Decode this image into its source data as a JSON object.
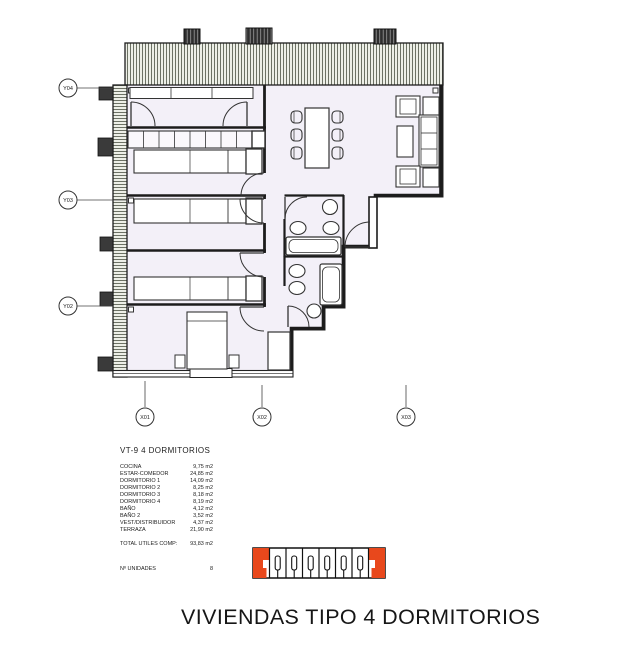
{
  "plan": {
    "markers": {
      "y04": "Y04",
      "y03": "Y03",
      "y02": "Y02",
      "x01": "X01",
      "x02": "X02",
      "x03": "X03"
    }
  },
  "summary": {
    "heading": "VT-9  4 DORMITORIOS",
    "rows": [
      {
        "label": "COCINA",
        "value": "9,75 m2"
      },
      {
        "label": "ESTAR-COMEDOR",
        "value": "24,85 m2"
      },
      {
        "label": "DORMITORIO 1",
        "value": "14,09 m2"
      },
      {
        "label": "DORMITORIO 2",
        "value": "8,25 m2"
      },
      {
        "label": "DORMITORIO 3",
        "value": "8,18 m2"
      },
      {
        "label": "DORMITORIO 4",
        "value": "8,19 m2"
      },
      {
        "label": "BAÑO",
        "value": "4,12 m2"
      },
      {
        "label": "BAÑO 2",
        "value": "3,52 m2"
      },
      {
        "label": "VEST/DISTRIBUIDOR",
        "value": "4,37 m2"
      },
      {
        "label": "TERRAZA",
        "value": "21,90 m2"
      }
    ],
    "total_label": "TOTAL UTILES COMP:",
    "total_value": "93,83 m2",
    "units_label": "Nº UNIDADES",
    "units_value": "8"
  },
  "key_plan": {
    "highlight_color": "#e8481c",
    "total_cells": 8,
    "highlighted_cells": 2
  },
  "footer_title": "VIVIENDAS TIPO 4 DORMITORIOS"
}
